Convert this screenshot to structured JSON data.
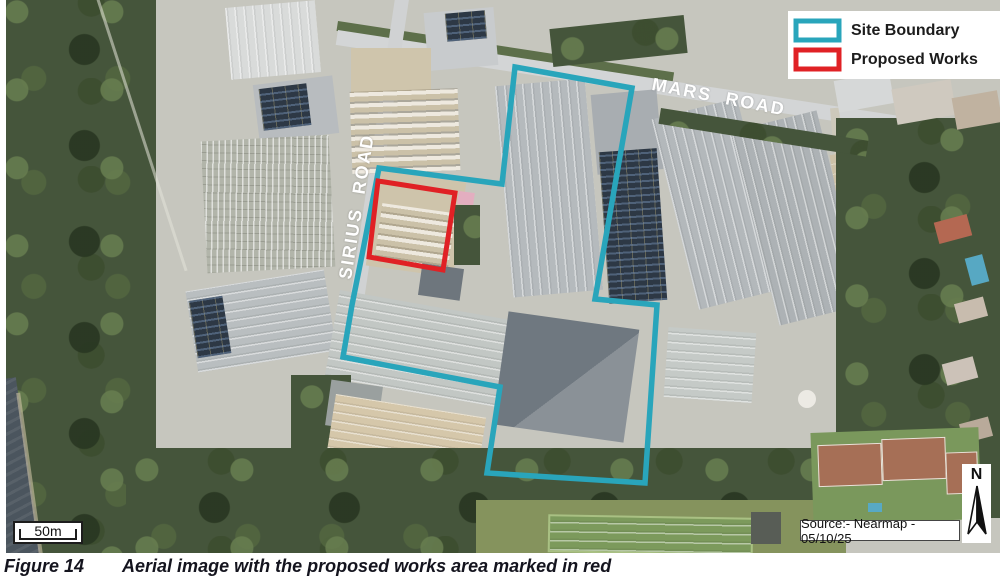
{
  "map": {
    "road_labels": [
      {
        "text": "MARS ROAD"
      },
      {
        "text": "SIRIUS ROAD"
      }
    ],
    "site_boundary": {
      "color": "#29A5BB",
      "points": "509,67 626,88 589,299 651,305 639,483 481,473 494,387 337,357 346,305 357,250 373,168 496,184"
    },
    "proposed_works": {
      "color": "#E02125",
      "points": "372,181 449,193 437,270 363,257"
    },
    "scale_label": "50m",
    "north_label": "N",
    "source_note": "Source:- Nearmap - 05/10/25"
  },
  "legend": {
    "items": [
      {
        "label": "Site Boundary",
        "swatch_color": "#29A5BB"
      },
      {
        "label": "Proposed Works",
        "swatch_color": "#E02125"
      }
    ]
  },
  "caption": {
    "figure_number": "Figure 14",
    "text": "Aerial image with the proposed works area marked in red"
  }
}
